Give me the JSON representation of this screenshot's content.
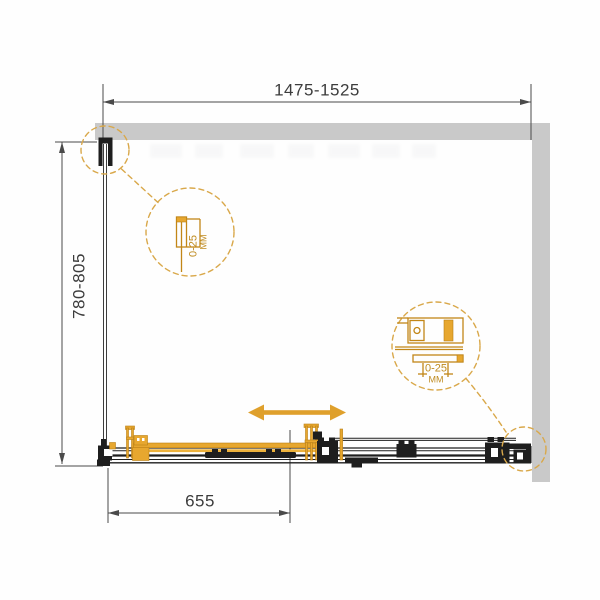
{
  "dims": {
    "width": "1475-1525",
    "depth": "780-805",
    "door": "655"
  },
  "details": {
    "left": {
      "range": "0-25",
      "unit": "MM"
    },
    "right": {
      "range": "0-25",
      "unit": "MM"
    }
  },
  "icons": {
    "slide_direction": "double-headed-horizontal-arrow"
  },
  "colors": {
    "accent_orange": "#DFA02C",
    "detail_orange": "#C28617",
    "wall_gray": "#C9C9C9",
    "line_black": "#1E1E1E",
    "dim_gray": "#4A4A4A",
    "text_gray": "#3C3C3C"
  }
}
